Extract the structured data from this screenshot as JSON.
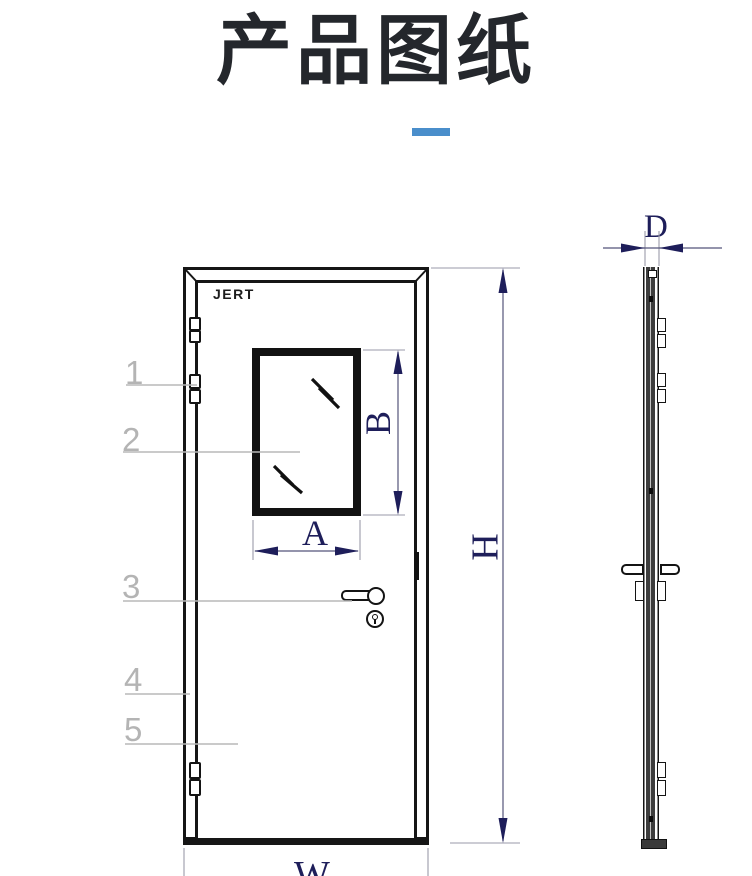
{
  "page": {
    "title": "产品图纸",
    "accent_color": "#4a8ecb"
  },
  "front_view": {
    "brand": "JERT",
    "callouts": [
      {
        "label": "1"
      },
      {
        "label": "2"
      },
      {
        "label": "3"
      },
      {
        "label": "4"
      },
      {
        "label": "5"
      }
    ],
    "dimensions": {
      "window_width": "A",
      "window_height": "B",
      "door_height": "H",
      "door_width": "W"
    }
  },
  "side_view": {
    "dimensions": {
      "thickness": "D"
    }
  },
  "colors": {
    "drawing_line": "#161616",
    "dimension": "#1e1e5a",
    "extension_line": "#9a9aa8",
    "callout": "#b4b4b4",
    "accent": "#4a8ecb"
  }
}
